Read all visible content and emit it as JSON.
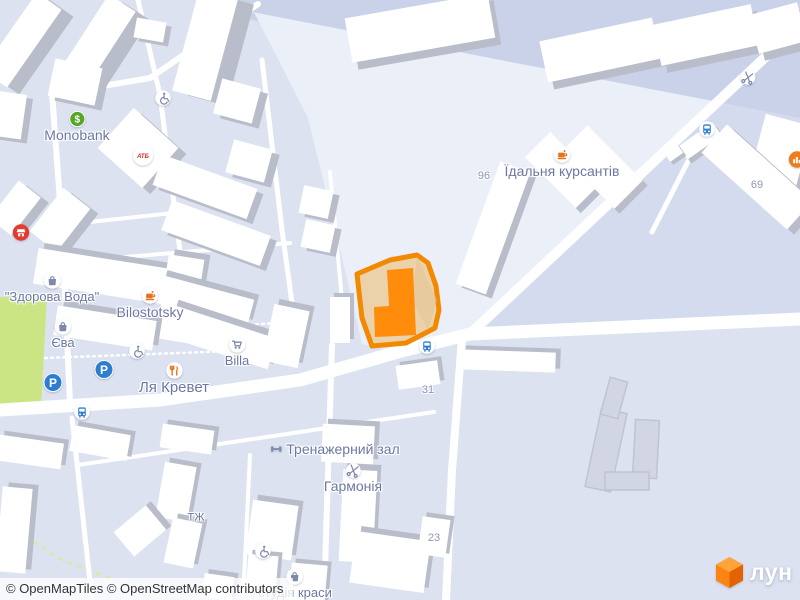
{
  "map": {
    "attribution": "© OpenMapTiles © OpenStreetMap contributors",
    "logo": {
      "text": "лун"
    },
    "colors": {
      "base": "#dce2f0",
      "open": "#ebeff8",
      "band": "#c9d2e9",
      "east": "#d4dbee",
      "park": "#cbe584",
      "road": "#ffffff",
      "bshadow": "#b9bdc9",
      "hfill": "#ecd2ab",
      "hstroke": "#f18a00",
      "hbld": "#ff8c0a",
      "label": "#6d78a2",
      "number": "#8e97b5",
      "orange": "#e8721c",
      "blue": "#2e7ed0",
      "green": "#55a629",
      "red": "#d7261f",
      "slate": "#7e89ac"
    },
    "pois": [
      {
        "name": "monobank",
        "icon": "monobank-icon",
        "label": "Monobank",
        "x": 77,
        "y": 120,
        "label_size": 14
      },
      {
        "name": "atb",
        "icon": "atb-icon",
        "x": 143,
        "y": 154
      },
      {
        "name": "shop-red",
        "icon": "shop-icon",
        "x": 21,
        "y": 233
      },
      {
        "name": "zdorova-voda",
        "icon": "bag-icon",
        "label": "\"Здорова Вода\"",
        "x": 52,
        "y": 281,
        "label_size": 13
      },
      {
        "name": "bilostotsky",
        "icon": "cafe-icon",
        "label": "Bilostotsky",
        "x": 150,
        "y": 296,
        "label_size": 14
      },
      {
        "name": "yeva",
        "icon": "bag-icon",
        "label": "Єва",
        "x": 63,
        "y": 327,
        "label_size": 13
      },
      {
        "name": "billa",
        "icon": "cart-icon",
        "label": "Billa",
        "x": 237,
        "y": 345,
        "label_size": 13
      },
      {
        "name": "la-krevet",
        "icon": "restaurant-icon",
        "label": "Ля Кревет",
        "x": 174,
        "y": 371,
        "label_size": 15
      },
      {
        "name": "idalnya-kursantiv",
        "icon": "cafe-icon",
        "label": "Їдальня курсантів",
        "x": 562,
        "y": 155,
        "label_size": 14
      },
      {
        "name": "trenazherny-zal",
        "icon": "dumbbell-icon",
        "label": "Тренажерний зал",
        "x": 334,
        "y": 449,
        "label_size": 14,
        "inline": true
      },
      {
        "name": "harmonia",
        "icon": "scissors-icon",
        "label": "Гармонія",
        "x": 353,
        "y": 472,
        "label_size": 14
      },
      {
        "name": "studia-krasy",
        "icon": "bag-icon",
        "label": "студія краси",
        "x": 295,
        "y": 577,
        "label_size": 13
      },
      {
        "name": "tzh",
        "label": "ТЖ",
        "x": 196,
        "y": 518,
        "label_size": 11
      },
      {
        "name": "parking-1",
        "icon": "parking-icon",
        "x": 53,
        "y": 382
      },
      {
        "name": "parking-2",
        "icon": "parking-icon",
        "x": 104,
        "y": 369
      },
      {
        "name": "bus-stop-1",
        "icon": "bus-icon",
        "x": 82,
        "y": 413
      },
      {
        "name": "bus-stop-2",
        "icon": "bus-icon",
        "x": 427,
        "y": 347
      },
      {
        "name": "bus-stop-3",
        "icon": "bus-icon",
        "x": 707,
        "y": 130
      },
      {
        "name": "scissors-shop",
        "icon": "scissors-icon",
        "x": 748,
        "y": 79
      },
      {
        "name": "wheelchair-1",
        "icon": "wheelchair-icon",
        "x": 163,
        "y": 99
      },
      {
        "name": "wheelchair-2",
        "icon": "wheelchair-icon",
        "x": 137,
        "y": 352
      },
      {
        "name": "wheelchair-3",
        "icon": "wheelchair-icon",
        "x": 263,
        "y": 552
      },
      {
        "name": "poi-right-edge",
        "icon": "chart-icon",
        "x": 797,
        "y": 160
      }
    ],
    "numbers": [
      {
        "label": "96",
        "x": 484,
        "y": 176
      },
      {
        "label": "69",
        "x": 757,
        "y": 185
      },
      {
        "label": "31",
        "x": 428,
        "y": 390
      },
      {
        "label": "23",
        "x": 434,
        "y": 538
      }
    ]
  }
}
